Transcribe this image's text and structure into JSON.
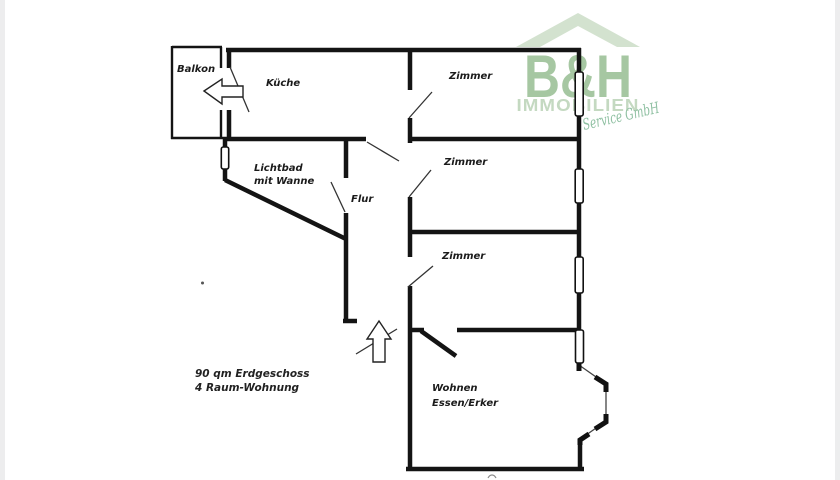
{
  "logo": {
    "brand": "B&H",
    "name": "IMMOBILIEN",
    "tagline": "Service GmbH",
    "colors": {
      "roof": "#d3e2cf",
      "brand": "#a6c7a2",
      "name": "#c4d9c1",
      "tagline": "#8fc0a2"
    }
  },
  "rooms": {
    "balkon": {
      "label": "Balkon"
    },
    "kueche": {
      "label": "Küche"
    },
    "zimmer_top": {
      "label": "Zimmer"
    },
    "zimmer_mid": {
      "label": "Zimmer"
    },
    "zimmer_bottom": {
      "label": "Zimmer"
    },
    "lichtbad": {
      "line1": "Lichtbad",
      "line2": "mit Wanne"
    },
    "flur": {
      "label": "Flur"
    },
    "wohnen": {
      "line1": "Wohnen",
      "line2": "Essen/Erker"
    }
  },
  "annotation": {
    "line1": "90 qm Erdgeschoss",
    "line2": "4 Raum-Wohnung"
  },
  "plan": {
    "wall_color": "#141414"
  }
}
